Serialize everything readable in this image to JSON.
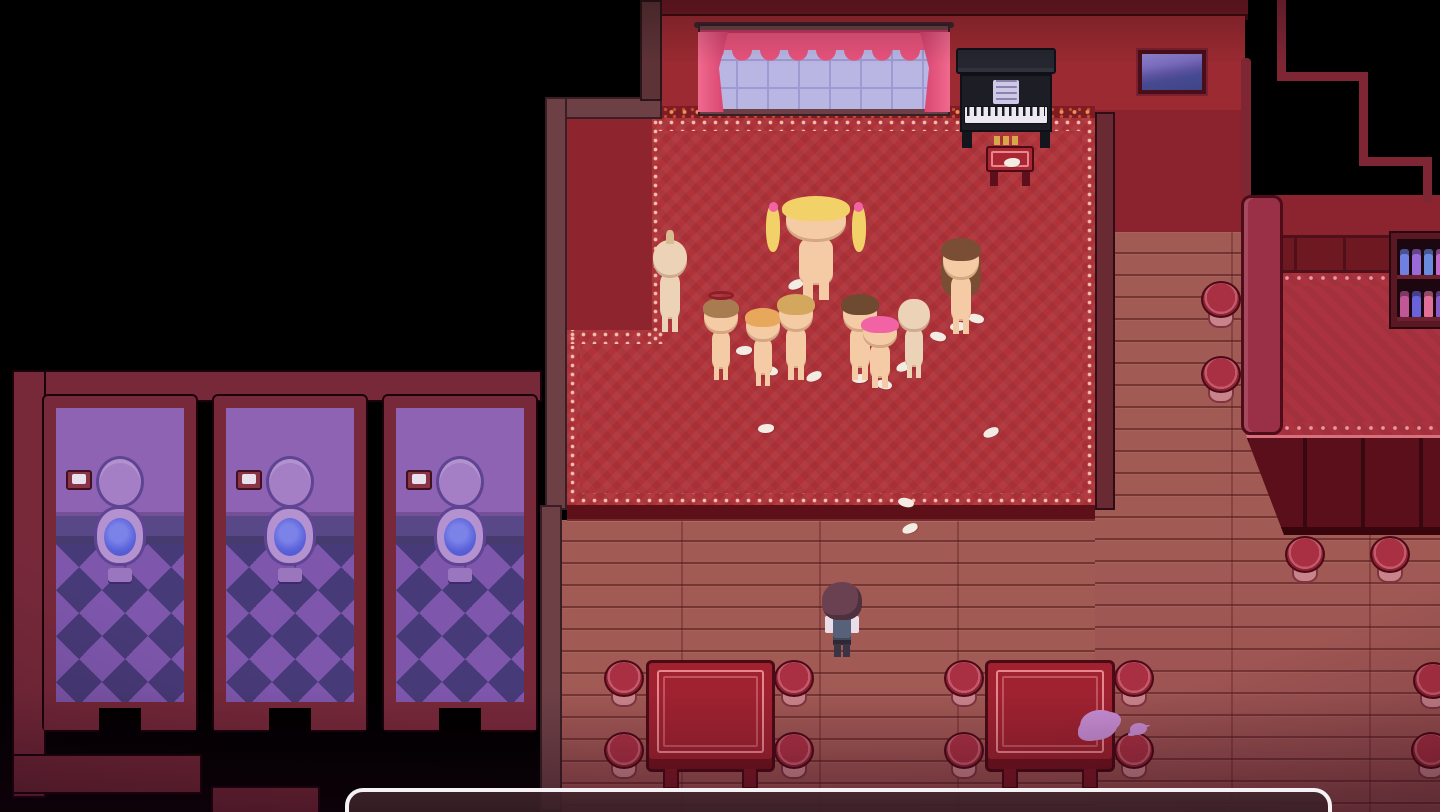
{
  "scene": {
    "name": "top-down-pixel-rpg-parlor",
    "view": "top-down"
  },
  "palette": {
    "background": "#000000",
    "wall_red": "#9c2a32",
    "wall_dark_red": "#8a232e",
    "wall_maroon_trim": "#701a24",
    "carpet_red": "#b0333a",
    "carpet_notch": "#8e242d",
    "lace_pink": "#f4bfae",
    "trim_orange": "#ef9350",
    "wood_floor": "#a15a54",
    "frame_gray_maroon": "#6d4046",
    "stall_frame": "#77293a",
    "stall_wall_purple": "#8f63b3",
    "stall_tile_light": "#7e57ad",
    "stall_tile_dark": "#473a78",
    "toilet_purple": "#b491cf",
    "toilet_water": "#5b63da",
    "curtain_pink": "#e8537c",
    "window_glass": "#bab6e4",
    "piano_black": "#20202a",
    "table_red": "#a02230",
    "table_line_pink": "#e8868e",
    "stool_red": "#a93043",
    "platform_carpet": "#ab3340",
    "platform_base": "#5a0f1a",
    "divider": "#9a3048",
    "dialog_border": "#f4f2f4",
    "skin": "#f4cba4",
    "splat_purple": "#c98fd6"
  },
  "dialog": {
    "text": ""
  },
  "player": {
    "name": "player-character",
    "x": 820,
    "y": 582,
    "w": 44,
    "h": 76,
    "hair": "#6a4150",
    "shirt": "#eadfe8",
    "vest": "#57627a",
    "pants": "#3a3444"
  },
  "characters": [
    {
      "name": "npc-pale-elf",
      "x": 646,
      "y": 236,
      "w": 48,
      "h": 96,
      "skin": "#ecd2b6",
      "hair": null,
      "tuft": "#d8bd92"
    },
    {
      "name": "npc-blonde-twintails",
      "x": 774,
      "y": 196,
      "w": 84,
      "h": 104,
      "skin": "#f4cba4",
      "hair": "#f2d268",
      "twintails": true,
      "ribbon": "#f263a6"
    },
    {
      "name": "npc-long-brunette",
      "x": 936,
      "y": 238,
      "w": 50,
      "h": 96,
      "skin": "#f4cba4",
      "hair": "#7a4e34",
      "long": true
    },
    {
      "name": "npc-halo-brown",
      "x": 698,
      "y": 298,
      "w": 46,
      "h": 82,
      "skin": "#f4cba4",
      "hair": "#a87c50",
      "halo": "#8a1f2a"
    },
    {
      "name": "npc-orange-hair",
      "x": 740,
      "y": 308,
      "w": 46,
      "h": 78,
      "skin": "#f4cba4",
      "hair": "#e8a85c"
    },
    {
      "name": "npc-sandy-hair",
      "x": 772,
      "y": 294,
      "w": 48,
      "h": 86,
      "skin": "#f4cba4",
      "hair": "#d4a75e"
    },
    {
      "name": "npc-dark-brown-hair",
      "x": 836,
      "y": 294,
      "w": 48,
      "h": 86,
      "skin": "#f4cba4",
      "hair": "#6e4a30"
    },
    {
      "name": "npc-pink-hair",
      "x": 856,
      "y": 316,
      "w": 48,
      "h": 72,
      "skin": "#f4cba4",
      "hair": "#f263a6"
    },
    {
      "name": "npc-pale-bald",
      "x": 892,
      "y": 296,
      "w": 44,
      "h": 82,
      "skin": "#ecd2b6",
      "hair": null
    }
  ],
  "furniture": {
    "tables": [
      {
        "x": 646,
        "y": 660,
        "w": 129,
        "h": 112
      },
      {
        "x": 985,
        "y": 660,
        "w": 130,
        "h": 112
      }
    ],
    "stools": [
      {
        "x": 604,
        "y": 660
      },
      {
        "x": 774,
        "y": 660
      },
      {
        "x": 604,
        "y": 732
      },
      {
        "x": 774,
        "y": 732
      },
      {
        "x": 944,
        "y": 660
      },
      {
        "x": 1114,
        "y": 660
      },
      {
        "x": 944,
        "y": 732
      },
      {
        "x": 1114,
        "y": 732
      },
      {
        "x": 1201,
        "y": 281
      },
      {
        "x": 1201,
        "y": 356
      },
      {
        "x": 1285,
        "y": 536
      },
      {
        "x": 1370,
        "y": 536
      },
      {
        "x": 1413,
        "y": 662
      },
      {
        "x": 1411,
        "y": 732
      }
    ],
    "stalls": [
      {
        "x": 44
      },
      {
        "x": 214
      },
      {
        "x": 384
      }
    ],
    "cabinet": {
      "x": 1391,
      "y": 233,
      "w": 62,
      "h": 94,
      "shelves": [
        [
          "#7080e0",
          "#9a6ad8",
          "#6a8ae0",
          "#c06ad0"
        ],
        [
          "#c05898",
          "#6a62d8",
          "#e07098",
          "#8a5ac8"
        ]
      ]
    }
  },
  "debris": {
    "tissues": [
      [
        788,
        280
      ],
      [
        736,
        346
      ],
      [
        762,
        366
      ],
      [
        806,
        372
      ],
      [
        852,
        374
      ],
      [
        876,
        380
      ],
      [
        896,
        362
      ],
      [
        950,
        322
      ],
      [
        968,
        314
      ],
      [
        983,
        428
      ],
      [
        758,
        424
      ],
      [
        898,
        498
      ],
      [
        902,
        524
      ],
      [
        1004,
        158
      ],
      [
        930,
        332
      ]
    ],
    "splats": [
      {
        "x": 1080,
        "y": 710,
        "w": 38,
        "h": 30
      },
      {
        "x": 1130,
        "y": 723,
        "w": 17,
        "h": 12
      }
    ]
  }
}
